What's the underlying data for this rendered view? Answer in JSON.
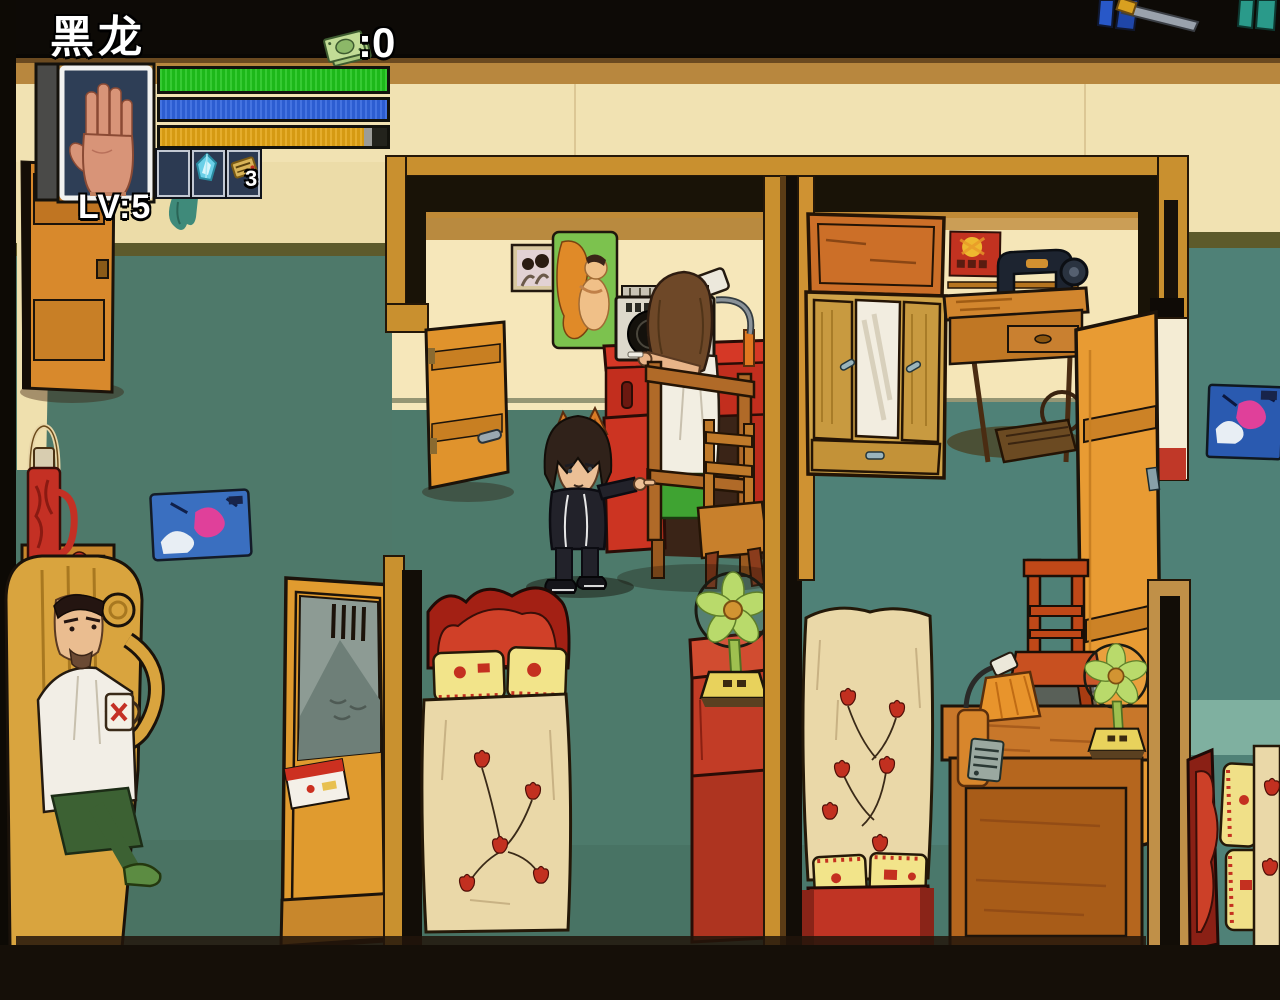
{
  "hud": {
    "player_name": "黑龙",
    "level_label": "LV:5",
    "money_label": ":0",
    "money_icon": "banknote-icon",
    "portrait_icon": "hand-portrait",
    "bars": {
      "health": {
        "color": "#1fc41c",
        "fill_pct": 100
      },
      "mana": {
        "color": "#2f63de",
        "fill_pct": 100
      },
      "stamina": {
        "color": "#e2a414",
        "fill_pct": 90
      }
    },
    "item_slots": [
      {
        "state": "empty"
      },
      {
        "state": "filled",
        "icon": "ice-crystal-icon"
      },
      {
        "state": "filled",
        "icon": "gold-pack-icon",
        "count": "3"
      }
    ]
  },
  "scene": {
    "characters": [
      {
        "name": "player-kid-cat-ears",
        "pose": "pointing-right"
      },
      {
        "name": "npc-at-boombox",
        "pose": "sitting-back-turned"
      },
      {
        "name": "npc-man-in-armchair",
        "pose": "sitting-holding-mug"
      }
    ],
    "rooms": [
      "left-bedroom",
      "middle-bedroom",
      "right-bedroom",
      "far-right-bedroom"
    ],
    "objects": [
      "open-door",
      "thermos",
      "tea-mugs",
      "crumpled-poster",
      "mirror-wardrobe",
      "tulip-blanket-bed",
      "boombox",
      "red-desk",
      "desk-lamp",
      "wooden-chair",
      "electric-fan",
      "red-cabinet",
      "large-wardrobe",
      "award-poster",
      "sewing-machine",
      "study-desk",
      "radio",
      "pinup-poster",
      "couple-photo"
    ]
  },
  "palette": {
    "wall_cream": "#f1e2b2",
    "wall_teal": "#4e796a",
    "wall_teal_right": "#4f8177",
    "wood_orange": "#d78a2e",
    "frame_black": "#191307",
    "desk_red": "#c8301f",
    "blanket_cream": "#ead8a8",
    "tulip_red": "#c23020",
    "fan_green": "#b9da6b",
    "hud_slot_bg": "#2c3a52",
    "hud_bar_health": "#1fc41c",
    "hud_bar_mana": "#2f63de",
    "hud_bar_stamina": "#e2a414"
  }
}
